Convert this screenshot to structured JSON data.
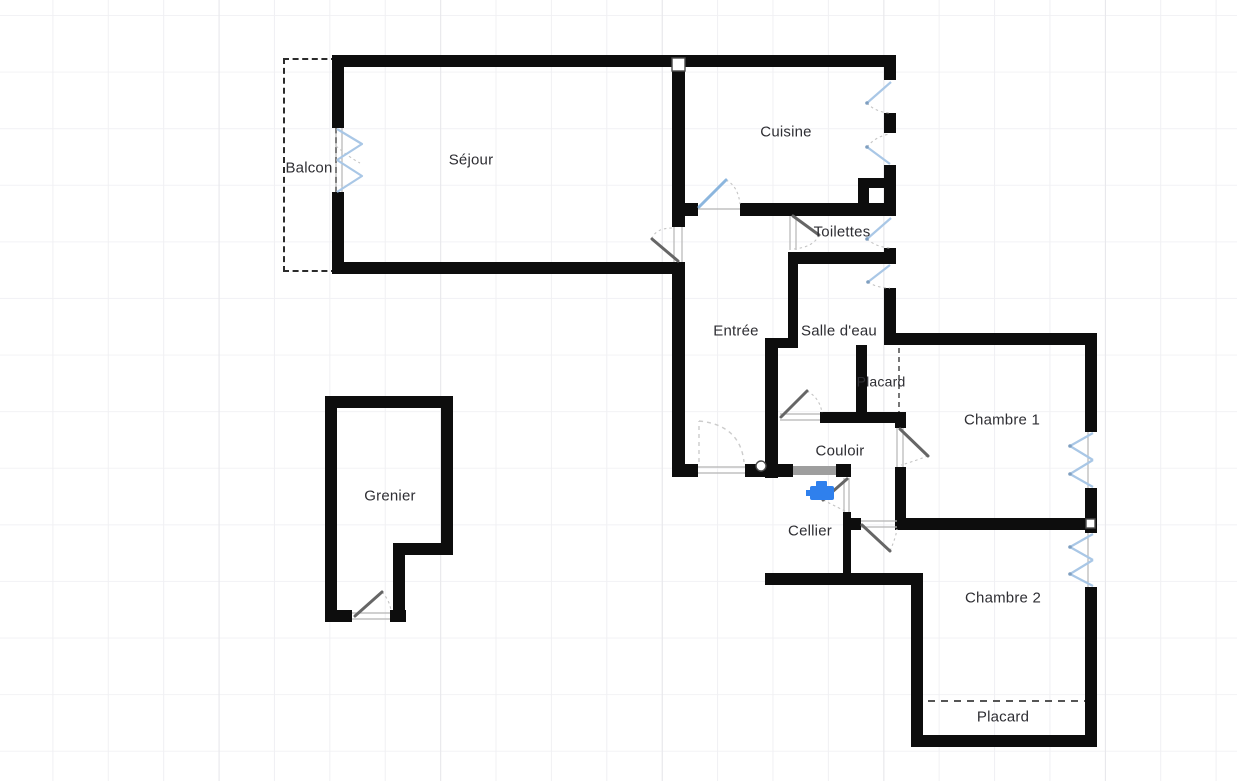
{
  "app": {
    "view": "floor-plan-canvas",
    "background": "#ffffff",
    "grid_color": "#f0f0f3",
    "grid_major_color": "#e7e7eb"
  },
  "palette": {
    "wall": "#0d0d0d",
    "door_leaf": "#666666",
    "glazed_door_leaf": "#8cb6de",
    "swing_arc": "#c4c4c4",
    "window_casement": "#a9c7e6",
    "opening_fill": "#9e9e9e",
    "dashed_feature": "#555555",
    "balcony_dash": "#2b2b2b",
    "fixture_blue": "#2f80ed",
    "label_text": "#2e2e33",
    "joint_marker": "#ffffff"
  },
  "rooms": [
    {
      "id": "balcon",
      "label": "Balcon"
    },
    {
      "id": "sejour",
      "label": "Séjour"
    },
    {
      "id": "cuisine",
      "label": "Cuisine"
    },
    {
      "id": "toilettes",
      "label": "Toilettes"
    },
    {
      "id": "entree",
      "label": "Entrée"
    },
    {
      "id": "salle_eau",
      "label": "Salle d'eau"
    },
    {
      "id": "placard_1",
      "label": "Placard"
    },
    {
      "id": "chambre_1",
      "label": "Chambre 1"
    },
    {
      "id": "couloir",
      "label": "Couloir"
    },
    {
      "id": "cellier",
      "label": "Cellier"
    },
    {
      "id": "grenier",
      "label": "Grenier"
    },
    {
      "id": "chambre_2",
      "label": "Chambre 2"
    },
    {
      "id": "placard_2",
      "label": "Placard"
    }
  ],
  "fixtures": [
    {
      "id": "faucet",
      "icon": "faucet-icon",
      "color": "#2f80ed",
      "location": "cellier"
    }
  ],
  "features": {
    "doors": [
      "sejour-entree",
      "entree-cuisine",
      "toilettes",
      "salle-eau",
      "front-entrance",
      "cellier",
      "chambre-1",
      "chambre-2",
      "grenier"
    ],
    "windows": [
      "sejour-french-window",
      "cuisine-window-1",
      "cuisine-window-2",
      "toilettes-window",
      "salle-eau-window",
      "chambre-1-window",
      "chambre-2-window"
    ],
    "openings": [
      "couloir-cellier-opening"
    ],
    "closet_fronts": [
      "placard-1-dashed-front",
      "placard-2-dashed-front"
    ]
  }
}
